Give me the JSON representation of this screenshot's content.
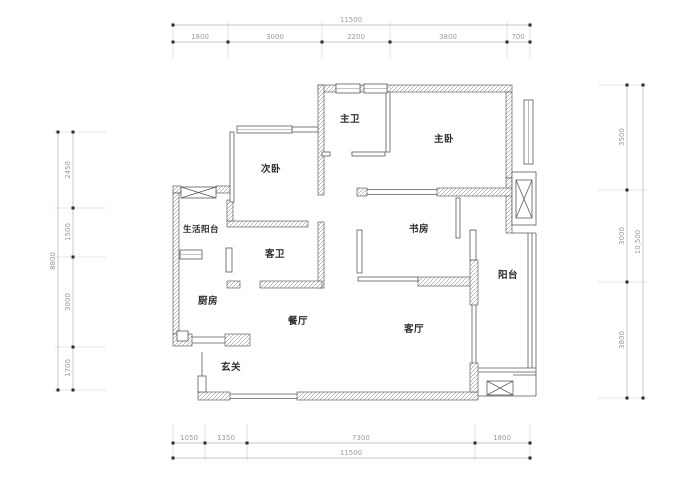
{
  "drawing": {
    "rooms": {
      "master_bath": "主卫",
      "master_bedroom": "主卧",
      "second_bedroom": "次卧",
      "utility_balcony": "生活阳台",
      "guest_bath": "客卫",
      "study": "书房",
      "balcony": "阳台",
      "kitchen": "厨房",
      "dining": "餐厅",
      "living": "客厅",
      "entry": "玄关"
    },
    "dims": {
      "top": {
        "total": "11500",
        "segments": [
          "1800",
          "3000",
          "2200",
          "3800",
          "700"
        ]
      },
      "bottom": {
        "total": "11500",
        "segments": [
          "1050",
          "1350",
          "7300",
          "1800"
        ]
      },
      "left": {
        "total": "8800",
        "segments": [
          "2450",
          "1500",
          "3000",
          "1700"
        ]
      },
      "right": {
        "total": "10,500",
        "segments": [
          "3500",
          "3000",
          "3800"
        ]
      }
    }
  }
}
